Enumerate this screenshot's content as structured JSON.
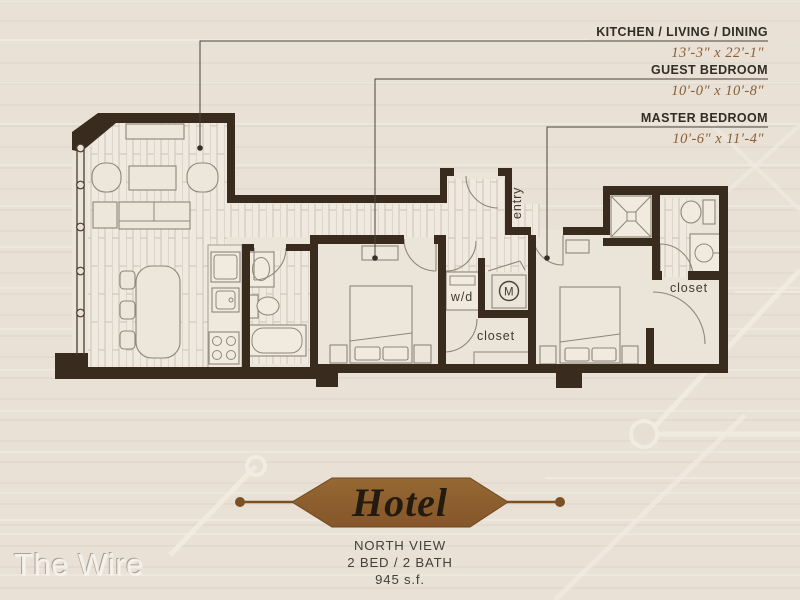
{
  "callouts": [
    {
      "name": "KITCHEN / LIVING / DINING",
      "dims": "13'-3\" x 22'-1\""
    },
    {
      "name": "GUEST BEDROOM",
      "dims": "10'-0\" x 10'-8\""
    },
    {
      "name": "MASTER BEDROOM",
      "dims": "10'-6\" x 11'-4\""
    }
  ],
  "plan_labels": {
    "entry": "entry",
    "washer_dryer": "w/d",
    "mechanical": "M",
    "guest_closet": "closet",
    "master_closet": "closet"
  },
  "banner": {
    "unit_name": "Hotel",
    "view_label": "NORTH VIEW",
    "config_label": "2 BED / 2 BATH",
    "area_label": "945 s.f."
  },
  "watermark": "The Wire",
  "colors": {
    "background": "#e9e1d6",
    "wall": "#392b1e",
    "banner_brown": "#8a5b2a",
    "dimension_text": "#8b5e36",
    "label_text": "#332c24"
  }
}
